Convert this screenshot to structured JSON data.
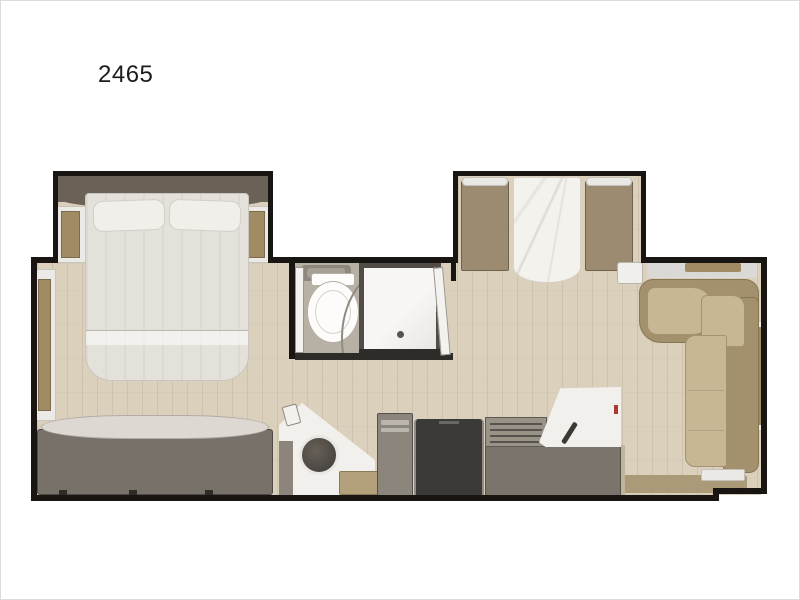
{
  "floorplan": {
    "model_label": "2465",
    "colors": {
      "wall": "#181512",
      "floor": "#dbd0bc",
      "bath_floor": "#b7b0a5",
      "bed": "#e4e1da",
      "headboard": "#6a6256",
      "wood": "#a08b62",
      "bench": "#9d8b71",
      "sofa_seat": "#c7b795",
      "sofa_back": "#a3906c",
      "dresser": "#77716a",
      "fridge": "#3b3a38",
      "counter": "#7b746a"
    },
    "rooms": [
      "bedroom",
      "bathroom",
      "dinette-slide",
      "living-area",
      "kitchen"
    ],
    "furniture": [
      "queen-bed",
      "nightstands",
      "dresser",
      "toilet",
      "shower",
      "vanity",
      "dinette-table",
      "dinette-benches",
      "sectional-sofa",
      "kitchen-sink",
      "pantry",
      "refrigerator",
      "range",
      "entry-step"
    ]
  }
}
